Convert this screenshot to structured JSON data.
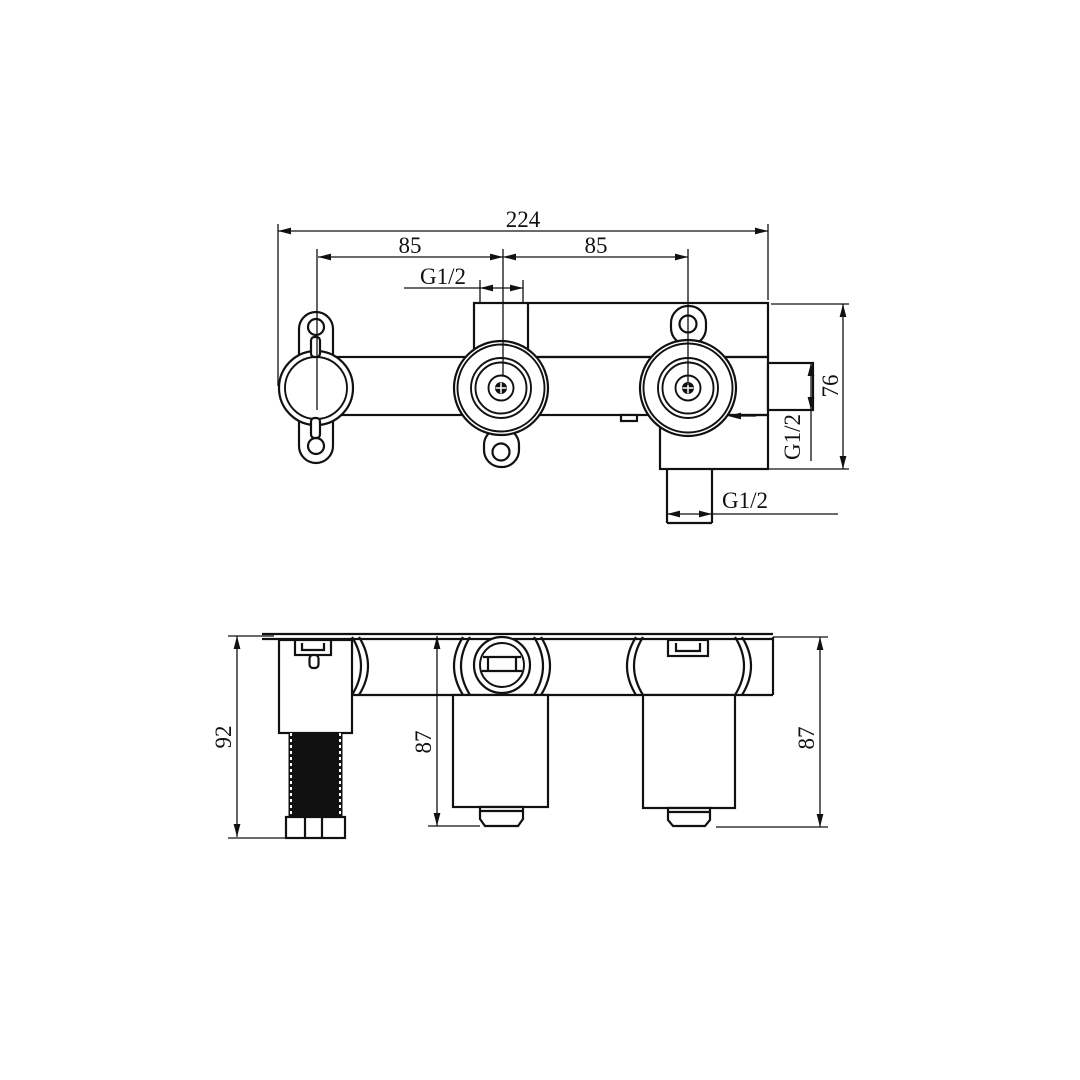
{
  "front_view": {
    "overall_width_mm": "224",
    "left_spacing_mm": "85",
    "right_spacing_mm": "85",
    "top_port_thread": "G1/2",
    "height_mm": "76",
    "side_port_thread": "G1/2",
    "bottom_port_thread": "G1/2"
  },
  "side_view": {
    "left_unit_height_mm": "92",
    "center_unit_height_mm": "87",
    "right_unit_height_mm": "87"
  },
  "colors": {
    "line": "#111111",
    "background": "#ffffff"
  }
}
